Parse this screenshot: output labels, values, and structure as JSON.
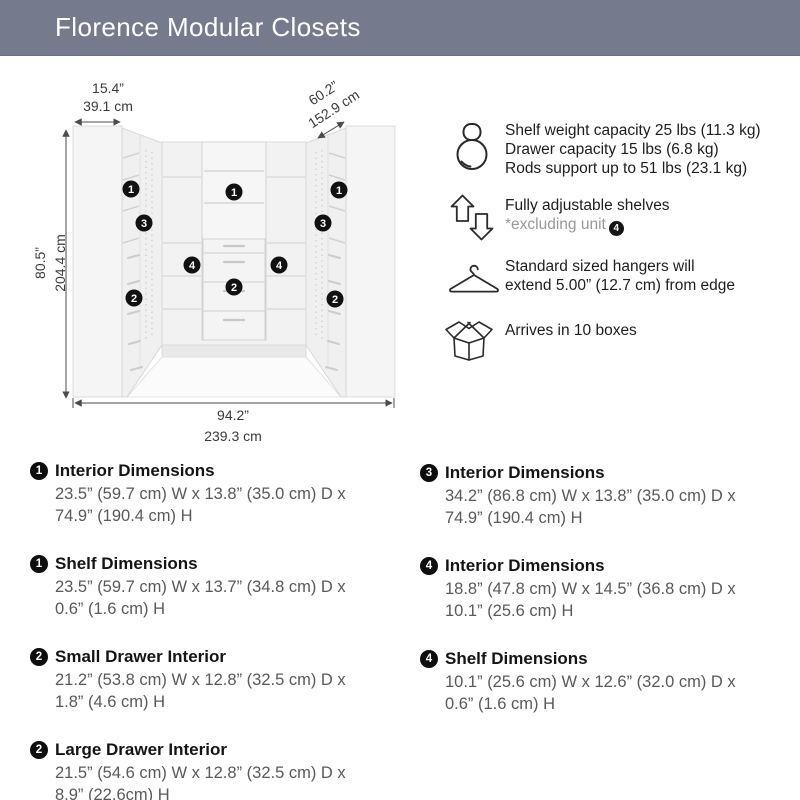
{
  "header": {
    "title": "Florence Modular Closets",
    "bg_color": "#757b8d",
    "text_color": "#ffffff"
  },
  "diagram": {
    "dims": {
      "side": {
        "in": "15.4”",
        "cm": "39.1 cm"
      },
      "back": {
        "in": "60.2”",
        "cm": "152.9 cm"
      },
      "height": {
        "in": "80.5”",
        "cm": "204.4 cm"
      },
      "total": {
        "in": "94.2”",
        "cm": "239.3 cm"
      }
    },
    "markers": [
      {
        "n": "1",
        "x": 131,
        "y": 189
      },
      {
        "n": "1",
        "x": 234,
        "y": 192
      },
      {
        "n": "1",
        "x": 339,
        "y": 190
      },
      {
        "n": "3",
        "x": 144,
        "y": 223
      },
      {
        "n": "3",
        "x": 323,
        "y": 223
      },
      {
        "n": "4",
        "x": 192,
        "y": 265
      },
      {
        "n": "4",
        "x": 279,
        "y": 265
      },
      {
        "n": "2",
        "x": 234,
        "y": 287
      },
      {
        "n": "2",
        "x": 134,
        "y": 298
      },
      {
        "n": "2",
        "x": 335,
        "y": 299
      }
    ],
    "marker_color": "#111111"
  },
  "features": [
    {
      "icon": "kettlebell-icon",
      "lines": [
        "Shelf weight capacity 25 lbs (11.3 kg)",
        "Drawer capacity 15 lbs (6.8 kg)",
        "Rods support up to 51 lbs (23.1 kg)"
      ]
    },
    {
      "icon": "adjustable-shelves-icon",
      "lines": [
        "Fully adjustable shelves"
      ],
      "note": "*excluding unit",
      "note_badge": "4"
    },
    {
      "icon": "hanger-icon",
      "lines": [
        "Standard sized hangers will",
        "extend 5.00” (12.7 cm) from edge"
      ]
    },
    {
      "icon": "open-box-icon",
      "lines": [
        "Arrives in 10 boxes"
      ]
    }
  ],
  "specs": {
    "left": [
      {
        "badge": "1",
        "title": "Interior Dimensions",
        "lines": [
          "23.5” (59.7 cm) W x 13.8” (35.0 cm) D x",
          "74.9” (190.4 cm) H"
        ]
      },
      {
        "badge": "1",
        "title": "Shelf Dimensions",
        "lines": [
          "23.5” (59.7 cm) W x 13.7” (34.8 cm) D x",
          "0.6” (1.6 cm) H"
        ]
      },
      {
        "badge": "2",
        "title": "Small Drawer Interior",
        "lines": [
          "21.2” (53.8 cm) W x 12.8” (32.5 cm) D x",
          "1.8” (4.6 cm) H"
        ]
      },
      {
        "badge": "2",
        "title": "Large Drawer Interior",
        "lines": [
          "21.5” (54.6 cm) W x 12.8” (32.5 cm) D x",
          "8.9” (22.6cm) H"
        ]
      }
    ],
    "right": [
      {
        "badge": "3",
        "title": "Interior Dimensions",
        "lines": [
          "34.2” (86.8 cm) W x 13.8” (35.0 cm) D x",
          "74.9” (190.4 cm) H"
        ]
      },
      {
        "badge": "4",
        "title": "Interior Dimensions",
        "lines": [
          "18.8” (47.8 cm) W x 14.5” (36.8 cm) D x",
          "10.1” (25.6 cm) H"
        ]
      },
      {
        "badge": "4",
        "title": "Shelf Dimensions",
        "lines": [
          "10.1” (25.6 cm) W x 12.6” (32.0 cm) D x",
          "0.6” (1.6 cm) H"
        ]
      }
    ]
  }
}
